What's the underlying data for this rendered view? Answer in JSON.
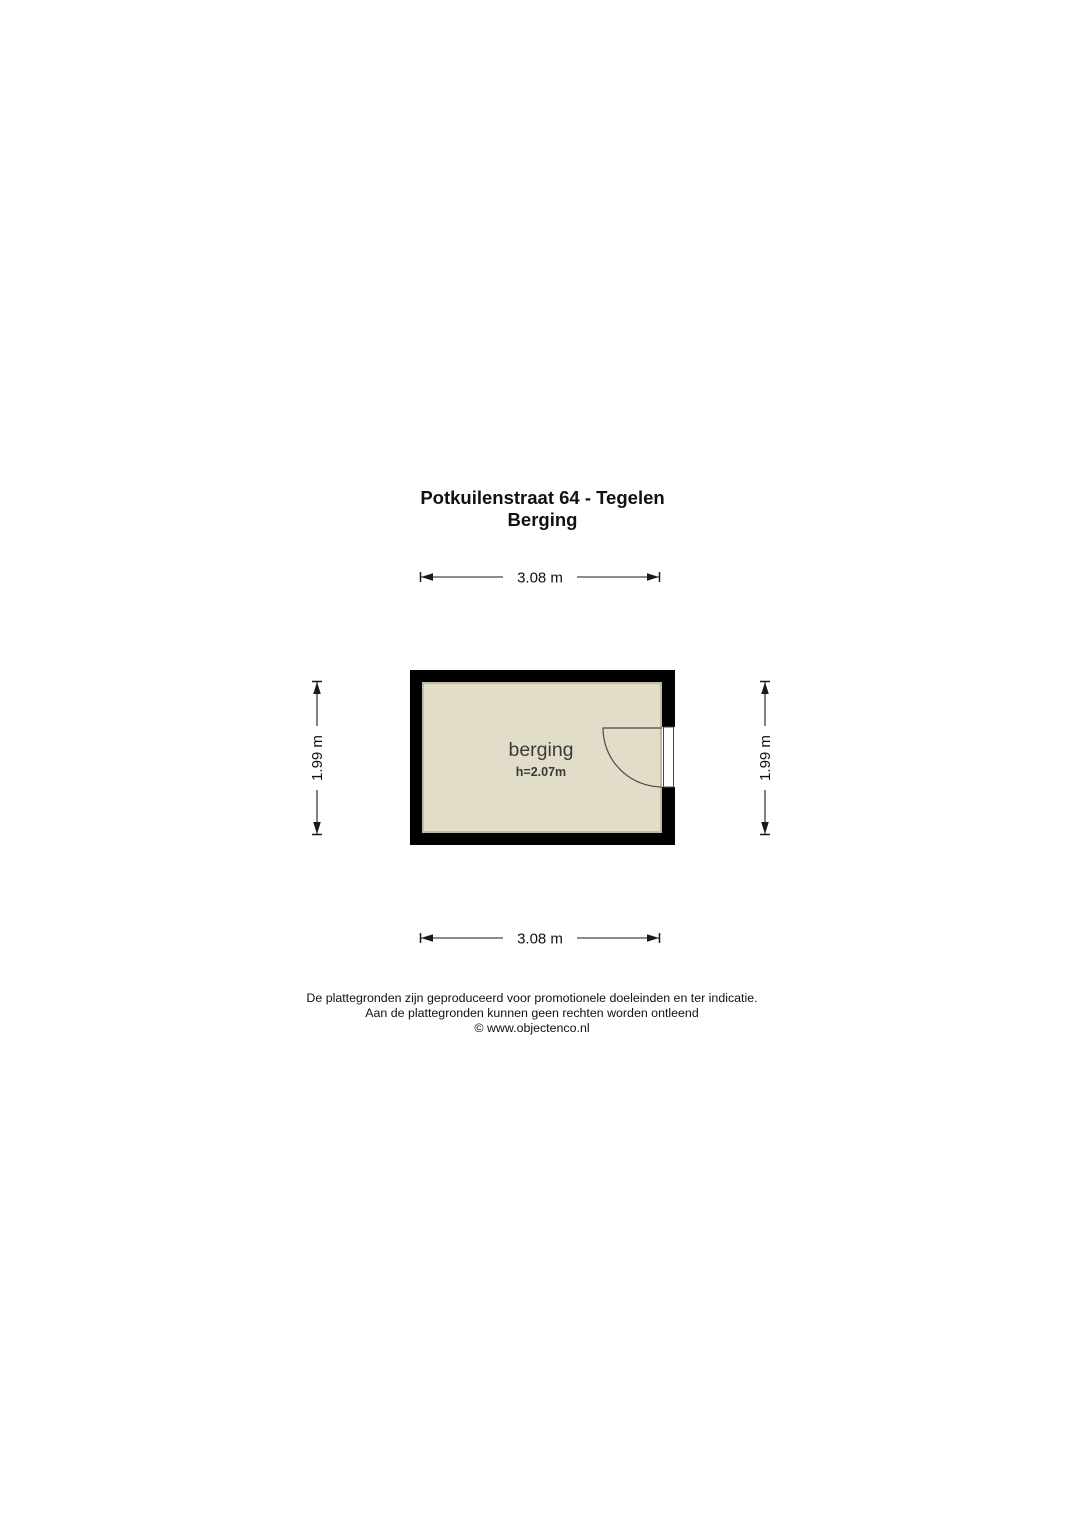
{
  "title": {
    "line1": "Potkuilenstraat 64 - Tegelen",
    "line2": "Berging"
  },
  "room": {
    "name": "berging",
    "ceiling_height": "h=2.07m"
  },
  "dimensions": {
    "top": {
      "label": "3.08 m"
    },
    "bottom": {
      "label": "3.08 m"
    },
    "left": {
      "label": "1.99 m"
    },
    "right": {
      "label": "1.99 m"
    }
  },
  "footer": {
    "line1": "De plattegronden zijn geproduceerd voor promotionele doeleinden en ter indicatie.",
    "line2": "Aan de plattegronden kunnen geen rechten worden ontleend",
    "line3": "© www.objectenco.nl"
  },
  "colors": {
    "wall": "#000000",
    "floor": "#e2ddc8",
    "line": "#1a1a1a",
    "room_text": "#3a3a3a"
  }
}
